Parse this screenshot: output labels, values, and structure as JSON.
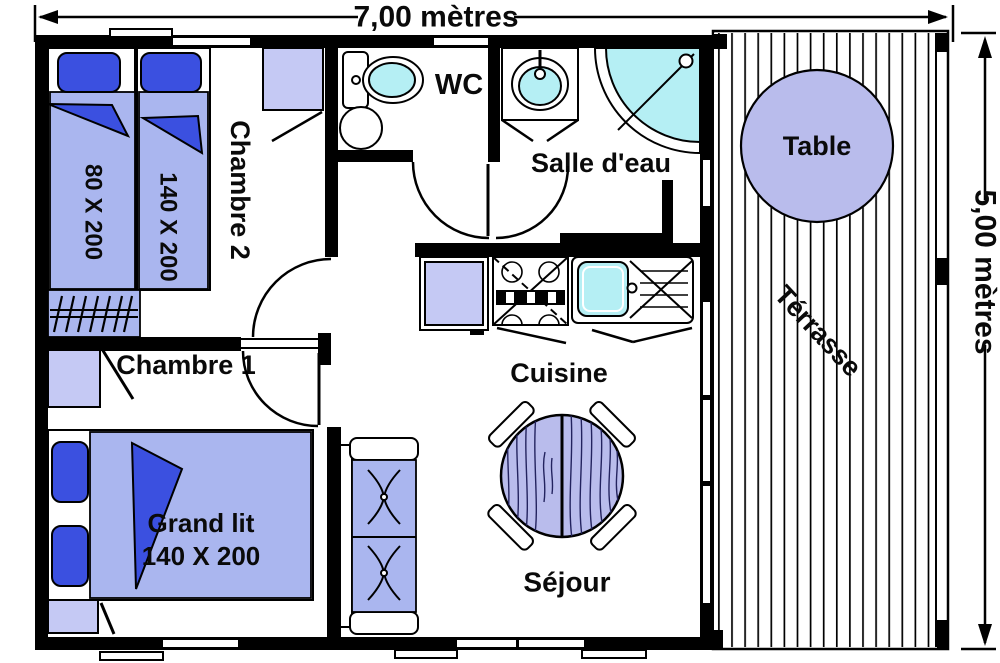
{
  "title": "Plan chalet",
  "dimensions": {
    "width_label": "7,00 mètres",
    "height_label": "5,00 mètres"
  },
  "rooms": {
    "chambre2": {
      "label": "Chambre 2",
      "beds": [
        {
          "size": "80 X 200"
        },
        {
          "size": "140 X 200"
        }
      ]
    },
    "wc": {
      "label": "WC"
    },
    "salle_eau": {
      "label": "Salle d'eau"
    },
    "chambre1": {
      "label": "Chambre 1",
      "bed": {
        "name": "Grand lit",
        "size": "140 X 200"
      }
    },
    "cuisine": {
      "label": "Cuisine"
    },
    "sejour": {
      "label": "Séjour"
    },
    "terrasse": {
      "label": "Térrasse",
      "table_label": "Table"
    }
  },
  "colors": {
    "wall": "#000000",
    "mattress": "#aab6ef",
    "furniture": "#c5c9f4",
    "pillow": "#3b50e0",
    "cyan": "#b5eff4",
    "table": "#b9bcec",
    "grain": "#23235f"
  }
}
